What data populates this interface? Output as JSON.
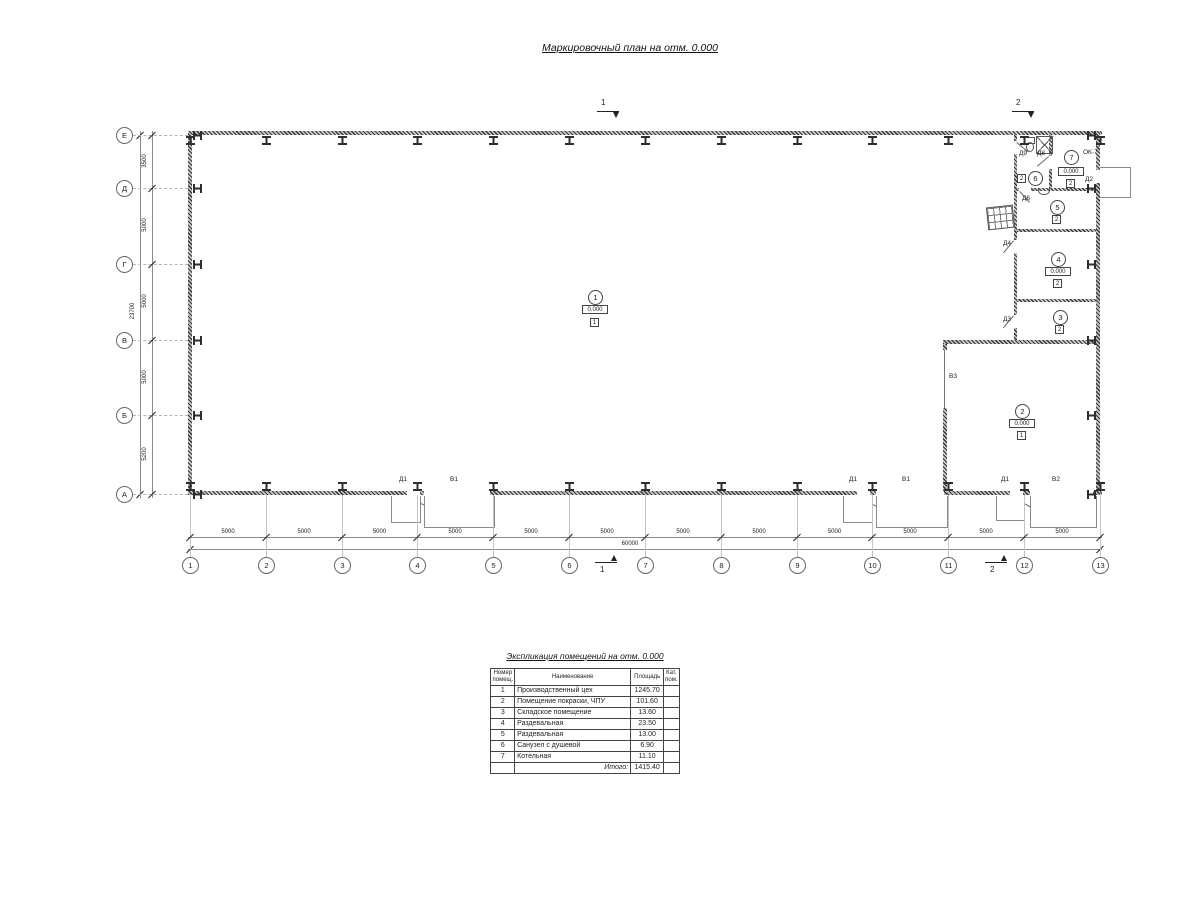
{
  "title": "Маркировочный план на отм. 0.000",
  "plan": {
    "axis_letters": [
      "Е",
      "Д",
      "Г",
      "В",
      "Б",
      "А"
    ],
    "axis_numbers": [
      "1",
      "2",
      "3",
      "4",
      "5",
      "6",
      "7",
      "8",
      "9",
      "10",
      "11",
      "12",
      "13"
    ],
    "dims_left": [
      "3500",
      "5000",
      "5000",
      "5000",
      "5200"
    ],
    "dims_left_total": "23700",
    "dims_bottom": [
      "5000",
      "5000",
      "5000",
      "5000",
      "5000",
      "5000",
      "5000",
      "5000",
      "5000",
      "5000",
      "5000",
      "5000"
    ],
    "dims_bottom_total": "60000",
    "section_marks": {
      "s1": "1",
      "s2": "2"
    },
    "rooms": [
      {
        "num": "1",
        "elev": "0.000",
        "cat": "1"
      },
      {
        "num": "2",
        "elev": "0.000",
        "cat": "1"
      },
      {
        "num": "3",
        "cat": "2"
      },
      {
        "num": "4",
        "elev": "0.000",
        "cat": "2"
      },
      {
        "num": "5",
        "cat": "2"
      },
      {
        "num": "6",
        "cat": "2"
      },
      {
        "num": "7",
        "elev": "0.000",
        "cat": "2"
      }
    ],
    "labels": {
      "d1a": "Д1",
      "v1a": "В1",
      "d1b": "Д1",
      "v1b": "В1",
      "d1c": "Д1",
      "v2": "В2",
      "v3": "В3",
      "d2": "Д2",
      "d3": "Д3",
      "d4": "Д4",
      "d6": "Д6",
      "d8": "Д8",
      "d9": "Д9",
      "ok7": "ОК-7"
    }
  },
  "table": {
    "title": "Экспликация помещений на отм. 0.000",
    "headers": [
      "Номер помещ.",
      "Наименование",
      "Площадь",
      "Кат. пом."
    ],
    "rows": [
      {
        "num": "1",
        "name": "Производственный цех",
        "area": "1245.70",
        "cat": ""
      },
      {
        "num": "2",
        "name": "Помещение покраски, ЧПУ",
        "area": "101.60",
        "cat": ""
      },
      {
        "num": "3",
        "name": "Складское помещение",
        "area": "13.60",
        "cat": ""
      },
      {
        "num": "4",
        "name": "Раздевальная",
        "area": "23.50",
        "cat": ""
      },
      {
        "num": "5",
        "name": "Раздевальная",
        "area": "13.00",
        "cat": ""
      },
      {
        "num": "6",
        "name": "Санузел с душевой",
        "area": "6.90",
        "cat": ""
      },
      {
        "num": "7",
        "name": "Котельная",
        "area": "11.10",
        "cat": ""
      }
    ],
    "total_label": "Итого:",
    "total_value": "1415.40"
  }
}
